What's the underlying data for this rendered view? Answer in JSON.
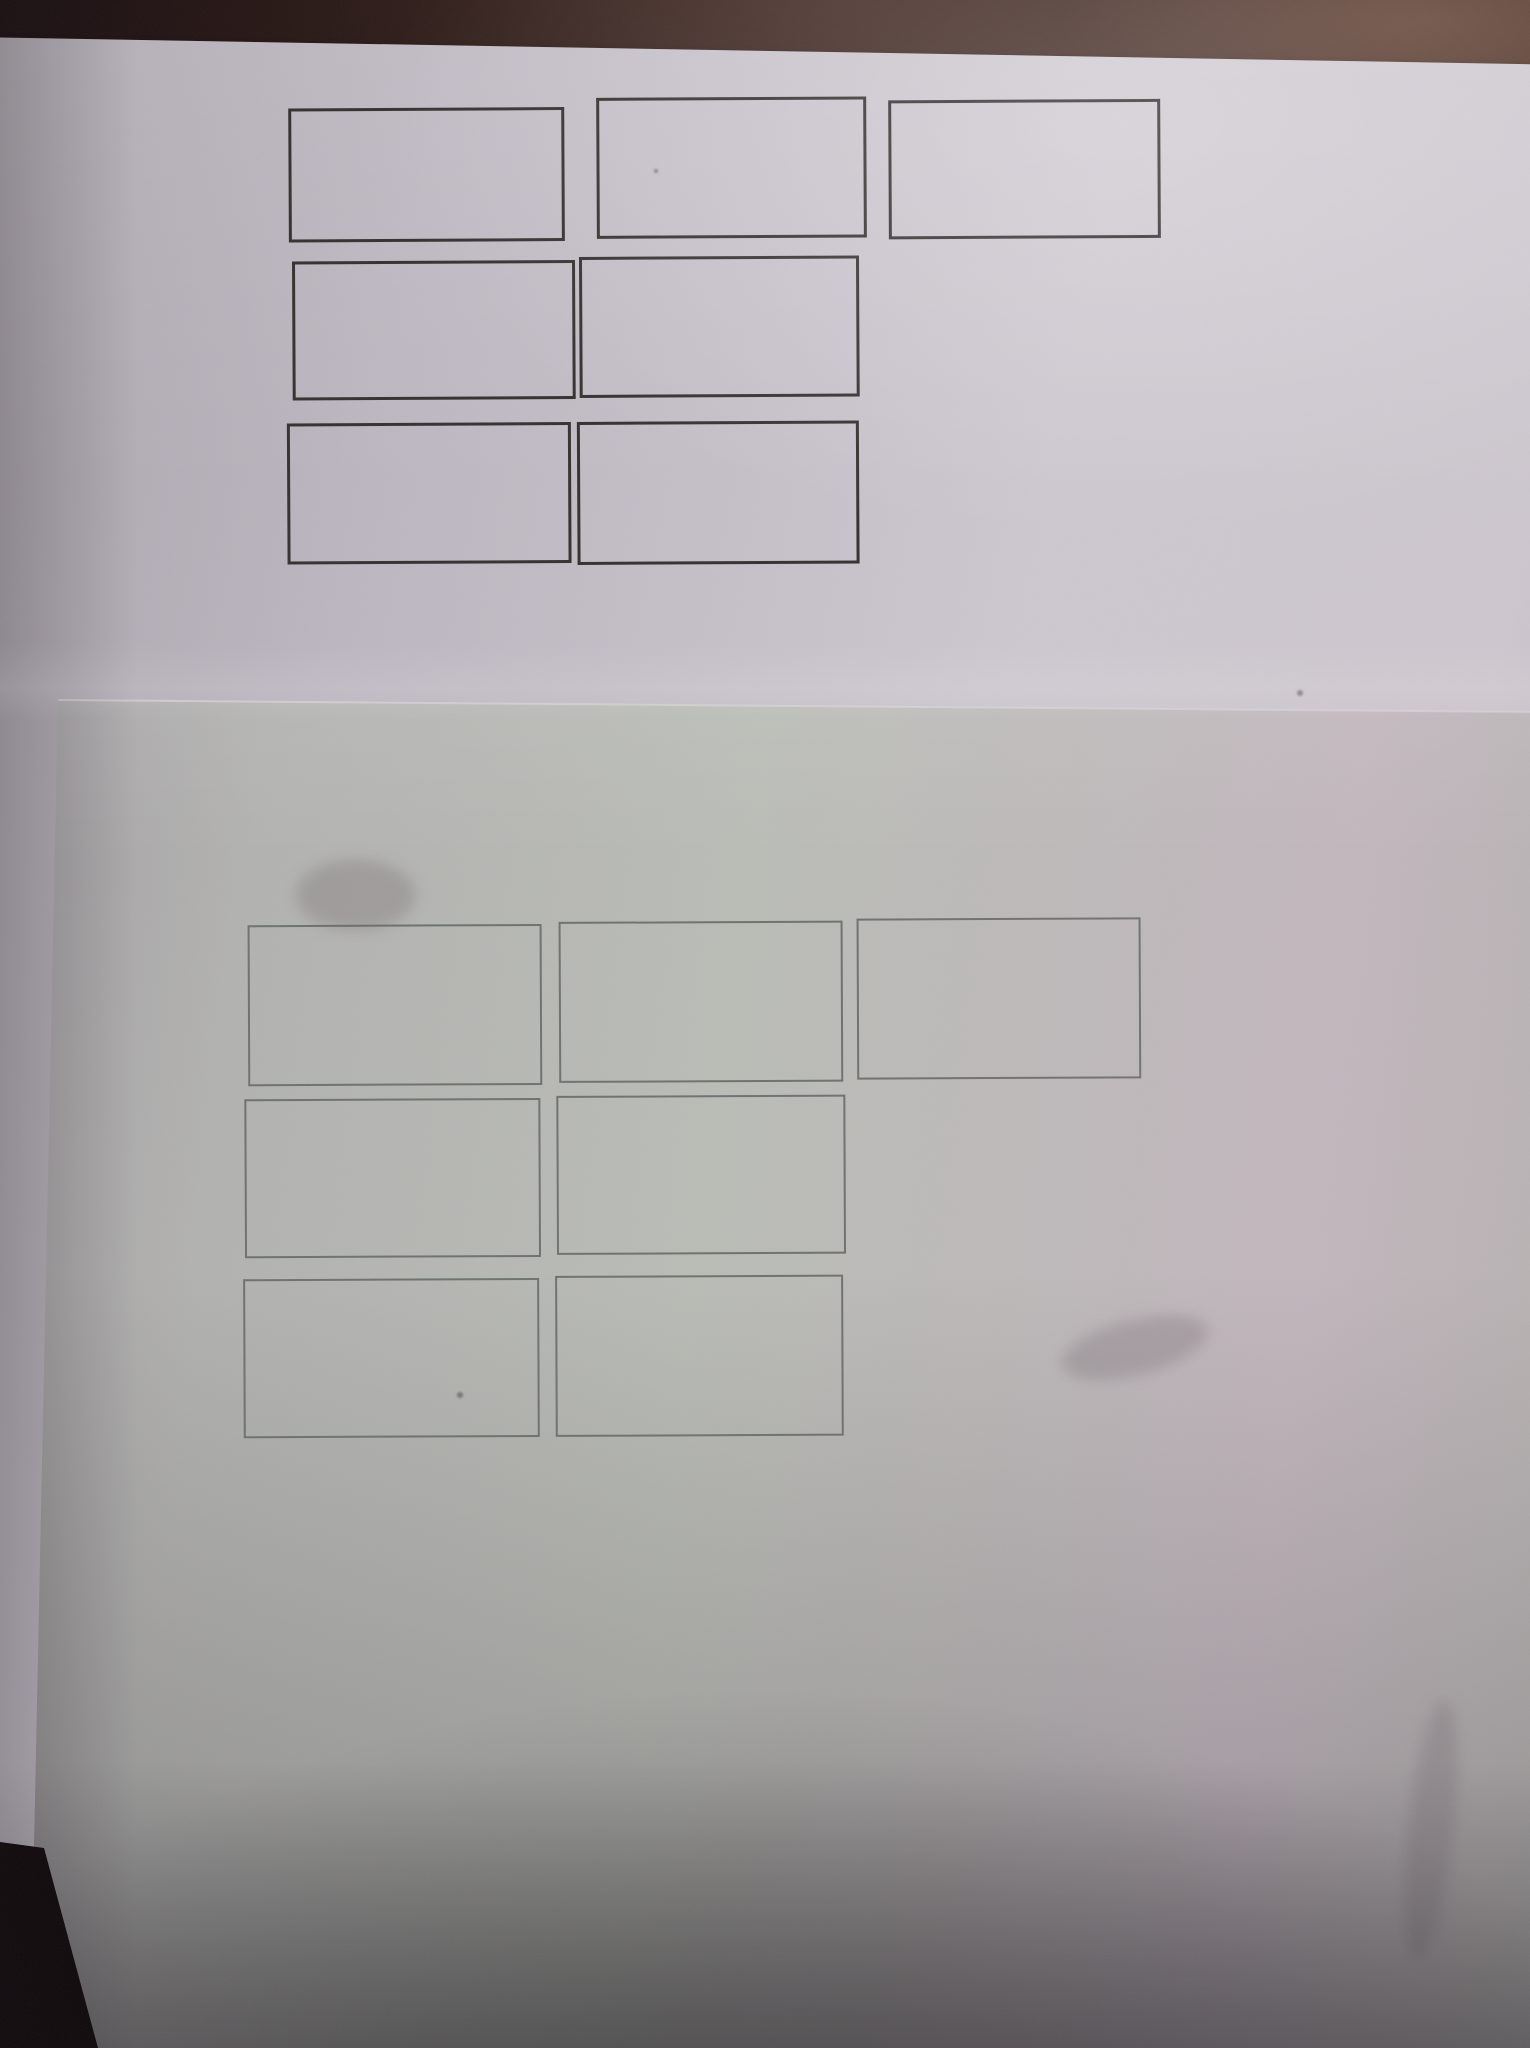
{
  "scene": {
    "type": "photograph",
    "subject": "Two overlapping sheets of white paper on a dark brown desk, each printed with seven empty rectangular outlines arranged in rows of 3, 2 and 2",
    "colors": {
      "desk-left": "#190d0f",
      "desk-mid": "#3a2521",
      "desk-right": "#523931",
      "paper1-bright": "#cdc7cf",
      "paper1-mid": "#bcb6c0",
      "paper1-shadow": "#a9a2ab",
      "paper2-light": "#babcb6",
      "paper2-mid": "#b2b2b0",
      "paper2-shadow": "#a09ba1",
      "paper2-pink": "#c0b7bd",
      "edge-highlight": "#d8d5da"
    },
    "sheets": [
      {
        "id": "top-sheet",
        "description": "upper bright sheet, seven dark-outlined empty rectangles",
        "rows": [
          3,
          2,
          2
        ],
        "box_count": 7,
        "border_color": "#33302f",
        "border_px": 3,
        "print_rotate_deg": -0.3,
        "frame": {
          "left": -30,
          "top": 37,
          "width": 1620,
          "height": 1810,
          "rotate_deg": 1.0
        },
        "boxes": [
          {
            "name": "row1-col1",
            "x": 293,
            "y": 106,
            "w": 276,
            "h": 134
          },
          {
            "name": "row1-col2",
            "x": 601,
            "y": 97,
            "w": 270,
            "h": 141
          },
          {
            "name": "row1-col3",
            "x": 893,
            "y": 101,
            "w": 272,
            "h": 139
          },
          {
            "name": "row2-col1",
            "x": 296,
            "y": 259,
            "w": 283,
            "h": 139
          },
          {
            "name": "row2-col2",
            "x": 583,
            "y": 256,
            "w": 280,
            "h": 141
          },
          {
            "name": "row3-col1",
            "x": 290,
            "y": 421,
            "w": 284,
            "h": 141
          },
          {
            "name": "row3-col2",
            "x": 580,
            "y": 421,
            "w": 282,
            "h": 143
          }
        ]
      },
      {
        "id": "bottom-sheet",
        "description": "lower overlapping sheet, seven faint gray-outlined empty rectangles",
        "rows": [
          3,
          2,
          2
        ],
        "box_count": 7,
        "border_color": "#6d716f",
        "border_px": 2,
        "print_rotate_deg": -0.25,
        "clip": [
          [
            58,
            700
          ],
          [
            1540,
            712
          ],
          [
            1540,
            2058
          ],
          [
            96,
            2058
          ],
          [
            34,
            1846
          ]
        ],
        "boxes": [
          {
            "name": "row1-col1",
            "x": 248,
            "y": 923,
            "w": 294,
            "h": 161
          },
          {
            "name": "row1-col2",
            "x": 559,
            "y": 921,
            "w": 284,
            "h": 161
          },
          {
            "name": "row1-col3",
            "x": 857,
            "y": 919,
            "w": 284,
            "h": 161
          },
          {
            "name": "row2-col1",
            "x": 244,
            "y": 1097,
            "w": 296,
            "h": 159
          },
          {
            "name": "row2-col2",
            "x": 556,
            "y": 1095,
            "w": 289,
            "h": 159
          },
          {
            "name": "row3-col1",
            "x": 242,
            "y": 1277,
            "w": 296,
            "h": 159
          },
          {
            "name": "row3-col2",
            "x": 554,
            "y": 1275,
            "w": 288,
            "h": 161
          }
        ]
      }
    ],
    "desk_wedge": [
      [
        0,
        1842
      ],
      [
        44,
        1848
      ],
      [
        98,
        2048
      ],
      [
        0,
        2048
      ]
    ],
    "specks": [
      {
        "x": 1300,
        "y": 693,
        "r": 3
      },
      {
        "x": 460,
        "y": 1395,
        "r": 3
      },
      {
        "x": 656,
        "y": 171,
        "r": 2
      }
    ],
    "smudges": [
      {
        "x": 1408,
        "y": 1700,
        "w": 46,
        "h": 260,
        "rotate": 6
      },
      {
        "x": 1060,
        "y": 1320,
        "w": 150,
        "h": 55,
        "rotate": -14
      },
      {
        "x": 296,
        "y": 860,
        "w": 120,
        "h": 70,
        "rotate": 0
      }
    ]
  }
}
